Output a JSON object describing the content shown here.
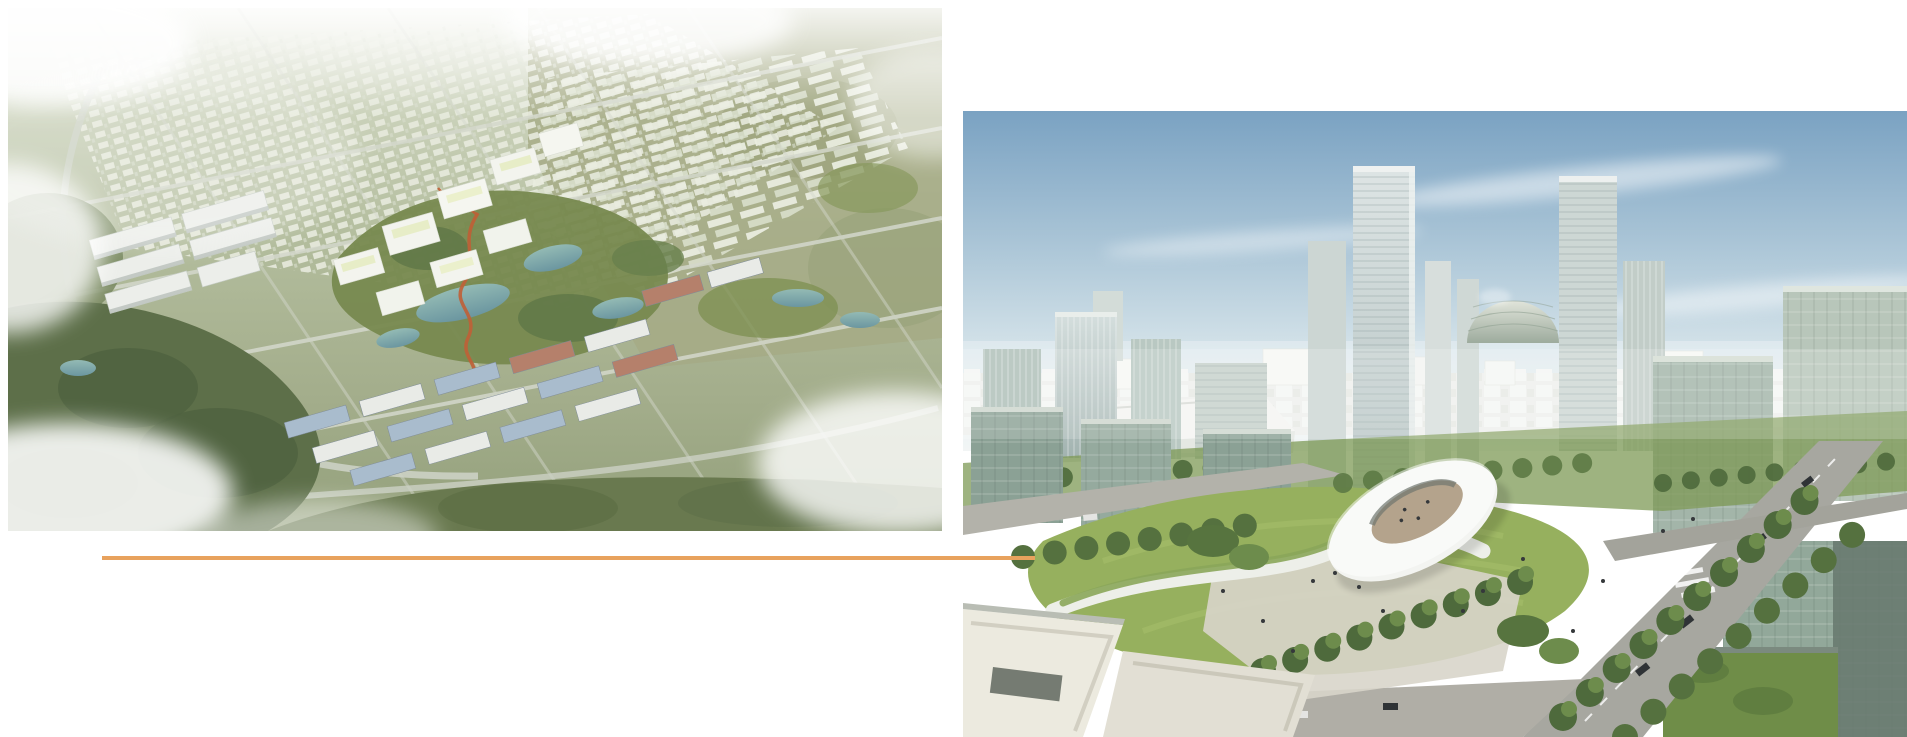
{
  "page": {
    "background_color": "#ffffff"
  },
  "divider": {
    "label": "orange horizontal divider line",
    "color": "#E8A25D"
  },
  "images": {
    "left": {
      "label": "Aerial bird's-eye rendering of a green campus master plan: dark forest and cloud patches on the left, central park with teal lakes and a winding red path, white courtyard buildings, rows of blue- and red-roofed warehouses, diagonal road grid fading into hazy suburbs and olive fields",
      "palette": {
        "haze_white": "#f1f3ec",
        "sage_green": "#b7c1a4",
        "olive_land": "#a5aa85",
        "forest_dark": "#5d6f49",
        "lake_teal": "#7fa8a6",
        "building_white": "#f2f4ef",
        "warehouse_blue_roof": "#a9bccd",
        "warehouse_red_roof": "#b5806b",
        "accent_red_path": "#c05f36",
        "road_gray": "#d4d8cc"
      }
    },
    "right": {
      "label": "Elevated rendering of a modern business district: blue sky over a hazy white skyline, glass high-rise towers, an egg-shaped domed building, a sweeping lawn plaza with a white ring-shaped canopy pavilion, tree-lined avenues with cars, glass cube offices with green roofs and white rooftops in the foreground",
      "palette": {
        "sky_blue": "#7aa2c2",
        "sky_haze": "#e9eff2",
        "distant_city_white": "#eef0ec",
        "glass_tower_light": "#cfd9d8",
        "glass_cube_dark": "#8ba195",
        "lawn_green": "#96b05e",
        "tree_green": "#55713f",
        "road_asphalt": "#a7a7a0",
        "paving_light": "#d8d5ca",
        "rooftop_white": "#eceadf"
      }
    }
  }
}
